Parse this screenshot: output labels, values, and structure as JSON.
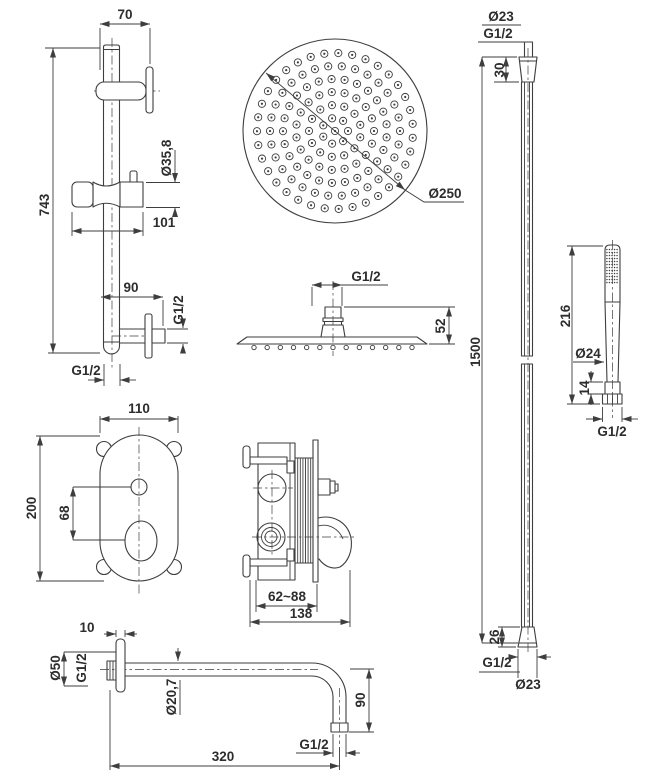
{
  "colors": {
    "line": "#3e3e3e",
    "text": "#2d2d2d",
    "background": "#ffffff"
  },
  "rail": {
    "top_offset": "70",
    "height": "743",
    "slider_dia": "Ø35,8",
    "holder_len": "101",
    "outlet_offset": "90",
    "outlet_thread": "G1/2",
    "bottom_thread": "G1/2"
  },
  "head_round": {
    "diameter": "Ø250",
    "cx": 335,
    "cy": 131,
    "r": 92,
    "dot_outer_r": 3.6,
    "dot_inner_r": 1.1,
    "nozzle_rings": [
      {
        "r": 0,
        "count": 1,
        "offset": 0
      },
      {
        "r": 13,
        "count": 7,
        "offset": 0
      },
      {
        "r": 26,
        "count": 13,
        "offset": 14
      },
      {
        "r": 39,
        "count": 19,
        "offset": 0
      },
      {
        "r": 52,
        "count": 25,
        "offset": 7
      },
      {
        "r": 65,
        "count": 30,
        "offset": 0
      },
      {
        "r": 78,
        "count": 35,
        "offset": 5
      }
    ]
  },
  "head_side": {
    "thread": "G1/2",
    "height": "52",
    "nozzles": {
      "count": 13,
      "x0": 254,
      "x1": 412,
      "y": 347.5,
      "r": 2.2
    }
  },
  "hose": {
    "top_dia": "Ø23",
    "top_thread": "G1/2",
    "top_nut": "30",
    "length": "1500",
    "bottom_nut": "26",
    "bottom_thread": "G1/2",
    "bottom_dia": "Ø23"
  },
  "handshower": {
    "length": "216",
    "dia": "Ø24",
    "nut": "14",
    "thread": "G1/2",
    "spray": {
      "cols": 5,
      "rows": 12,
      "x0": 606.9,
      "y0": 249.5,
      "dx": 2.55,
      "dy": 3,
      "r": 0.75
    }
  },
  "mixer_front": {
    "width": "110",
    "height": "200",
    "hole_spacing": "68"
  },
  "mixer_side": {
    "mount_depth": "62~88",
    "total_depth": "138"
  },
  "spout": {
    "flange_thickness": "10",
    "flange_dia": "Ø50",
    "wall_thread": "G1/2",
    "tube_dia": "Ø20,7",
    "drop": "90",
    "length": "320",
    "outlet_thread": "G1/2"
  }
}
